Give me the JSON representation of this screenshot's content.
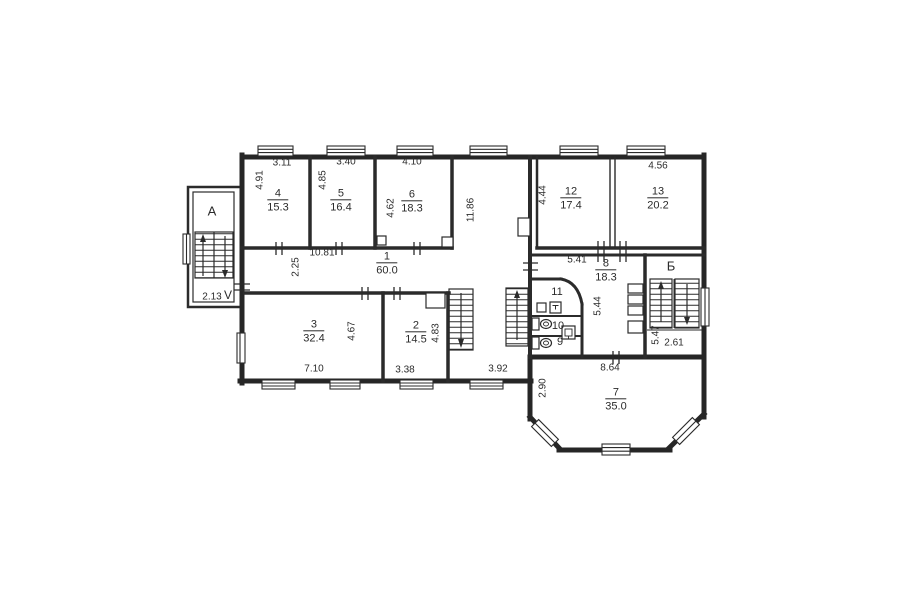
{
  "plan": {
    "title": "floor-plan",
    "line_color": "#2b2b2b",
    "background": "#ffffff",
    "rooms": [
      {
        "number": "4",
        "area": "15.3",
        "x": 278,
        "y": 201
      },
      {
        "number": "5",
        "area": "16.4",
        "x": 341,
        "y": 201
      },
      {
        "number": "6",
        "area": "18.3",
        "x": 412,
        "y": 202
      },
      {
        "number": "12",
        "area": "17.4",
        "x": 571,
        "y": 199
      },
      {
        "number": "13",
        "area": "20.2",
        "x": 658,
        "y": 199
      },
      {
        "number": "1",
        "area": "60.0",
        "x": 387,
        "y": 264
      },
      {
        "number": "3",
        "area": "32.4",
        "x": 314,
        "y": 332
      },
      {
        "number": "2",
        "area": "14.5",
        "x": 416,
        "y": 333
      },
      {
        "number": "8",
        "area": "18.3",
        "x": 606,
        "y": 271
      },
      {
        "number": "7",
        "area": "35.0",
        "x": 616,
        "y": 400
      }
    ],
    "small_rooms": [
      {
        "label": "11",
        "x": 557,
        "y": 292
      },
      {
        "label": "10",
        "x": 558,
        "y": 326
      },
      {
        "label": "9",
        "x": 560,
        "y": 342
      }
    ],
    "stairs": {
      "a": "A",
      "b": "Б",
      "a_mark": "V"
    },
    "dimensions": [
      {
        "text": "3.11",
        "x": 282,
        "y": 163,
        "v": false
      },
      {
        "text": "3.40",
        "x": 346,
        "y": 162,
        "v": false
      },
      {
        "text": "4.10",
        "x": 412,
        "y": 162,
        "v": false
      },
      {
        "text": "4.56",
        "x": 658,
        "y": 166,
        "v": false
      },
      {
        "text": "4.91",
        "x": 260,
        "y": 180,
        "v": true
      },
      {
        "text": "4.85",
        "x": 323,
        "y": 180,
        "v": true
      },
      {
        "text": "4.62",
        "x": 391,
        "y": 208,
        "v": true
      },
      {
        "text": "11.86",
        "x": 471,
        "y": 210,
        "v": true
      },
      {
        "text": "4.44",
        "x": 543,
        "y": 195,
        "v": true
      },
      {
        "text": "10.81",
        "x": 322,
        "y": 253,
        "v": false
      },
      {
        "text": "2.25",
        "x": 296,
        "y": 267,
        "v": true
      },
      {
        "text": "5.41",
        "x": 577,
        "y": 260,
        "v": false
      },
      {
        "text": "5.44",
        "x": 598,
        "y": 306,
        "v": true
      },
      {
        "text": "4.67",
        "x": 352,
        "y": 331,
        "v": true
      },
      {
        "text": "4.83",
        "x": 436,
        "y": 333,
        "v": true
      },
      {
        "text": "7.10",
        "x": 314,
        "y": 369,
        "v": false
      },
      {
        "text": "3.38",
        "x": 405,
        "y": 370,
        "v": false
      },
      {
        "text": "3.92",
        "x": 498,
        "y": 369,
        "v": false
      },
      {
        "text": "8.64",
        "x": 610,
        "y": 368,
        "v": false
      },
      {
        "text": "2.90",
        "x": 543,
        "y": 388,
        "v": true
      },
      {
        "text": "5.47",
        "x": 656,
        "y": 335,
        "v": true
      },
      {
        "text": "2.61",
        "x": 674,
        "y": 343,
        "v": false
      },
      {
        "text": "2.13",
        "x": 212,
        "y": 297,
        "v": false
      }
    ]
  }
}
